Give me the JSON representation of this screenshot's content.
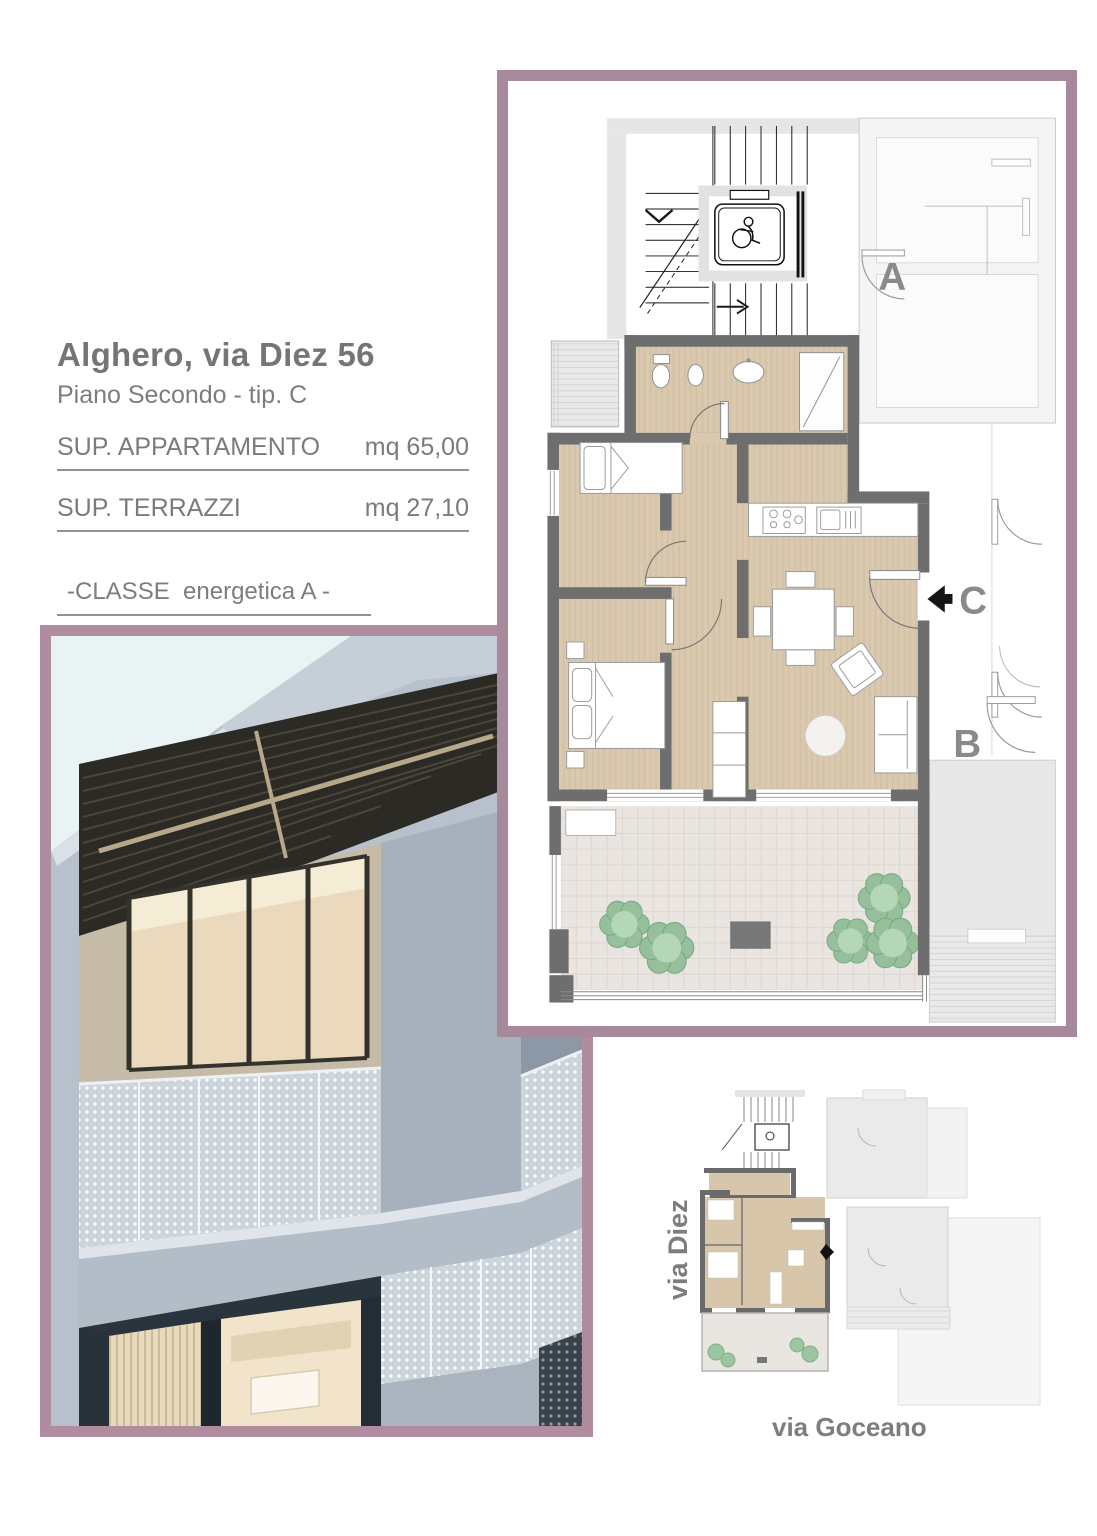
{
  "header": {
    "title": "Alghero, via Diez 56",
    "subtitle": "Piano Secondo - tip. C"
  },
  "areas": {
    "apartment": {
      "label": "SUP. APPARTAMENTO",
      "value": "mq 65,00"
    },
    "terrace": {
      "label": "SUP. TERRAZZI",
      "value": "mq 27,10"
    }
  },
  "energy": {
    "label": "-CLASSE  energetica A -"
  },
  "floorplan": {
    "unit_labels": {
      "a": "A",
      "b": "B",
      "c": "C"
    }
  },
  "siteplan": {
    "street_left": "via Diez",
    "street_bottom": "via Goceano"
  },
  "icons": {
    "elevator": "wheelchair-icon",
    "entrance": "entrance-arrow-icon",
    "site_entrance": "site-entrance-arrow-icon"
  },
  "colors": {
    "frame_plan": "#a8899b",
    "frame_photo": "#b08d9e",
    "wall": "#6e6e6e",
    "floor": "#d9c8ad",
    "terrace_floor": "#eae5e1",
    "bush_green": "#9cc5a1",
    "label_gray": "#8a8a8a",
    "text_gray": "#787878"
  }
}
